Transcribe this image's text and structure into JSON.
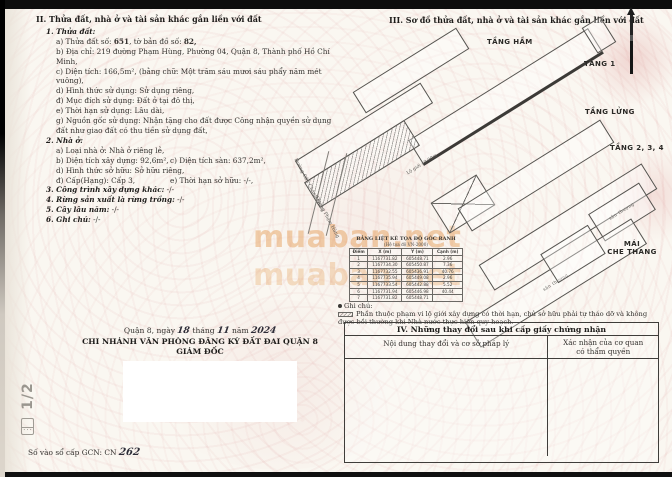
{
  "watermark": {
    "text": "muaban.net"
  },
  "s2": {
    "title": "II. Thửa đất, nhà ở và tài sản khác gắn liền với đất",
    "land": {
      "heading": "1. Thửa đất:",
      "a_pre": "a) Thửa đất số: ",
      "a_num": "651",
      "a_mid": ", tờ bản đồ số: ",
      "a_num2": "82,",
      "b": "b) Địa chỉ: 219 đường Phạm Hùng, Phường 04, Quận 8, Thành phố Hồ Chí Minh,",
      "c": "c) Diện tích: 166,5m², (bằng chữ: Một trăm sáu mươi sáu phẩy năm mét vuông),",
      "d": "d) Hình thức sử dụng: Sử dụng riêng,",
      "dd": "đ) Mục đích sử dụng: Đất ở tại đô thị,",
      "e": "e) Thời hạn sử dụng: Lâu dài,",
      "g": "g) Nguồn gốc sử dụng: Nhận tặng cho đất được Công nhận quyền sử dụng đất như giao đất có thu tiền sử dụng đất,"
    },
    "house": {
      "heading": "2. Nhà ở:",
      "a": "a) Loại nhà ở: Nhà ở riêng lẻ,",
      "b": "b) Diện tích xây dựng: 92,6m²,",
      "c": "c) Diện tích sàn: 637,2m²,",
      "d": "d) Hình thức sở hữu: Sở hữu riêng,",
      "dd": "đ) Cấp(Hạng): Cấp 3,",
      "e": "e) Thời hạn sở hữu: -/-,"
    },
    "item3": {
      "label": "3. Công trình xây dựng khác:",
      "value": " -/-"
    },
    "item4": {
      "label": "4. Rừng sản xuất là rừng trồng:",
      "value": " -/-"
    },
    "item5": {
      "label": "5. Cây lâu năm:",
      "value": " -/-"
    },
    "item6": {
      "label": "6. Ghi chú:",
      "value": " -/-"
    }
  },
  "signing": {
    "date_pre": "Quận 8, ngày",
    "day": "18",
    "m_label": "tháng",
    "month": "11",
    "y_label": "năm",
    "year": "2024",
    "office": "CHI NHÁNH VĂN PHÒNG ĐĂNG KÝ ĐẤT ĐAI QUẬN 8",
    "role": "GIÁM ĐỐC"
  },
  "footer": {
    "page_marker": "1/2",
    "gcn_label": "Số vào sổ cấp GCN: CN ",
    "gcn_num": "262"
  },
  "s3": {
    "title": "III. Sơ đồ thửa đất, nhà ở và tài sản khác gắn liền với đất",
    "labels": {
      "basement": "TẦNG HẦM",
      "f1": "TẦNG 1",
      "mezz": "TẦNG LỬNG",
      "f234": "TẦNG 2, 3, 4",
      "roof_line1": "MÁI",
      "roof_line2": "CHE THANG"
    },
    "inner": {
      "terrace": "sân thượng"
    },
    "streets": {
      "s1": "Đường Cầu Chánh Hưng",
      "s2": "Đường Phạm Hùng"
    },
    "road_label": "Lộ giới 40.00m",
    "coord": {
      "title": "BẢNG LIỆT KÊ TỌA ĐỘ GÓC RANH",
      "subtitle": "(Hệ tọa độ VN-2000)",
      "headers": [
        "Điểm",
        "X (m)",
        "Y (m)",
        "Cạnh (m)"
      ],
      "rows": [
        [
          "1",
          "1167731.82",
          "605448.71",
          "2.96"
        ],
        [
          "2",
          "1167734.30",
          "605450.87",
          "7.36"
        ],
        [
          "3",
          "1167732.55",
          "605436.91",
          "40.76"
        ],
        [
          "4",
          "1167735.94",
          "605449.08",
          "2.96"
        ],
        [
          "5",
          "1167733.54",
          "605442.88",
          "5.52"
        ],
        [
          "6",
          "1167731.94",
          "605446.98",
          "40.44"
        ],
        [
          "7",
          "1167731.82",
          "605448.71",
          ""
        ]
      ]
    },
    "note_label": "Ghi chú:",
    "note_text": "Phần thuộc phạm vi lộ giới xây dựng có thời hạn, chủ sở hữu phải tự tháo dỡ và không được bồi thường khi Nhà nước thực hiện quy hoạch."
  },
  "s4": {
    "title": "IV. Những thay đổi sau khi cấp giấy chứng nhận",
    "col1": "Nội dung thay đổi và cơ sở pháp lý",
    "col2a": "Xác nhận của cơ quan",
    "col2b": "có thẩm quyền"
  },
  "colors": {
    "guilloche_pink": "#e5baba",
    "watermark_orange": "#e29242",
    "ink": "#33312e"
  }
}
